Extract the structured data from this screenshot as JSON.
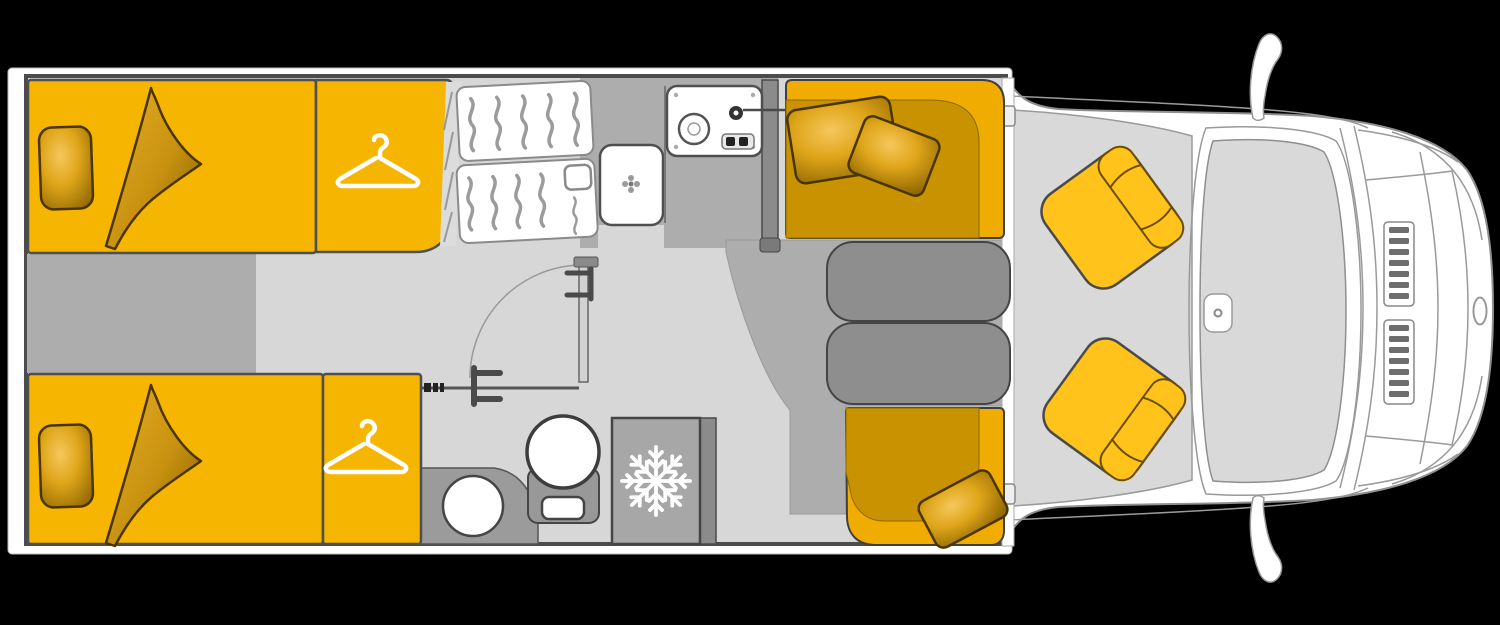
{
  "diagram": {
    "kind": "motorhome-floorplan-top-view",
    "orientation": "vehicle front on the right, rear on the left",
    "rooms": [
      {
        "name": "rear-bedroom",
        "items": [
          "single-bed-top",
          "single-bed-bottom",
          "wardrobe-top",
          "wardrobe-bottom"
        ]
      },
      {
        "name": "bathroom",
        "items": [
          "closet-shelves",
          "washbasin",
          "toilet",
          "vanity-counter",
          "vanity-basin",
          "bathroom-door"
        ]
      },
      {
        "name": "kitchen",
        "items": [
          "sink-stove-unit",
          "refrigerator"
        ]
      },
      {
        "name": "dinette",
        "items": [
          "front-bench",
          "rear-bench",
          "table",
          "cushions"
        ]
      },
      {
        "name": "cab",
        "items": [
          "driver-seat",
          "passenger-seat",
          "windshield",
          "dashboard-vents",
          "side-mirrors",
          "rearview-mirror"
        ]
      }
    ]
  },
  "icons": [
    {
      "name": "hanger-icon",
      "meaning": "wardrobe / clothes rail",
      "count": 2,
      "color": "#FFFFFF"
    },
    {
      "name": "snowflake-icon",
      "meaning": "refrigerator",
      "count": 1,
      "color": "#FFFFFF"
    }
  ],
  "counts": {
    "beds": 2,
    "cab_seats": 2,
    "dinette_benches": 2,
    "pillows": 5,
    "mirrors": 2
  },
  "colors": {
    "background": "#000000",
    "body": "#FFFFFF",
    "floor_light": "#D7D7D7",
    "floor_cab": "#D9D9D9",
    "floor_mid": "#ADADAD",
    "wall_dark": "#4C4C4C",
    "partition": "#8B8B8B",
    "furniture": "#F6B501",
    "furniture_line": "#4F4F4F",
    "bench": "#C89200",
    "bench_highlight": "#F0AC00",
    "seat": "#FFC31C",
    "table": "#8E8E8E",
    "counter": "#9B9B9B",
    "fridge": "#A7A7A7",
    "icon": "#FFFFFF"
  }
}
